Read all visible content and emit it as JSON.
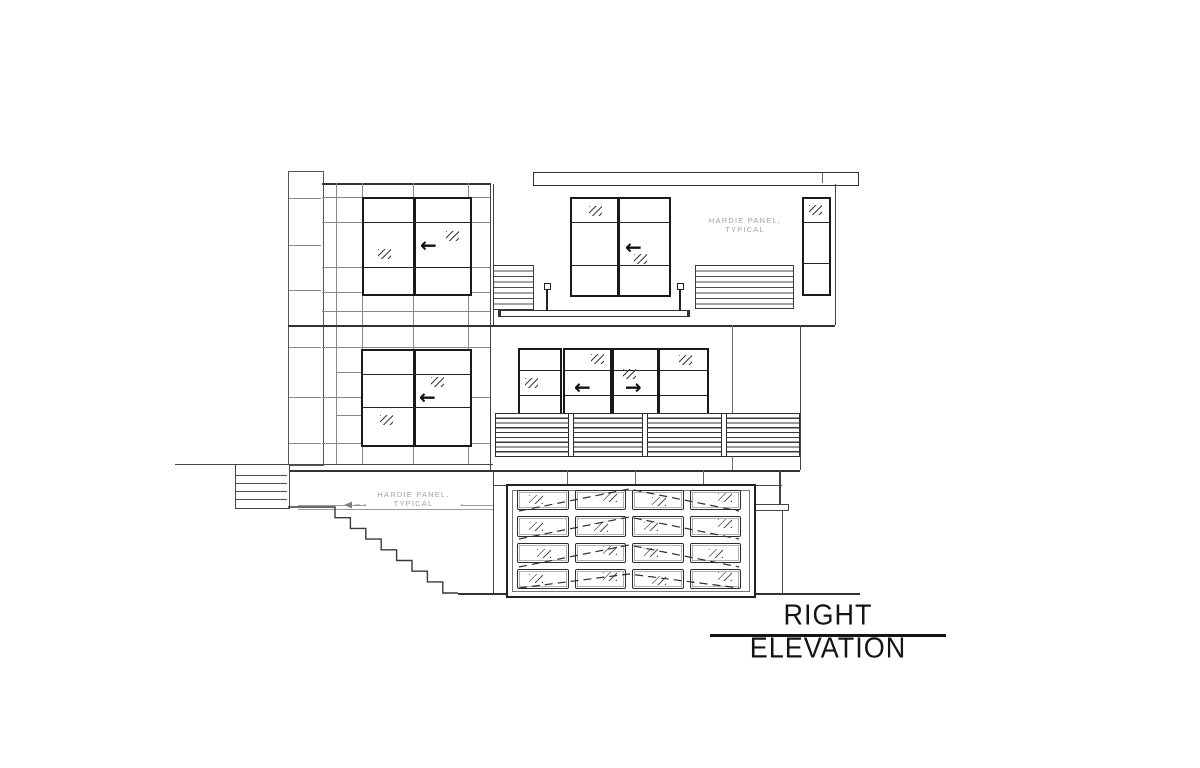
{
  "sheet": {
    "title": "RIGHT ELEVATION",
    "labels": {
      "hardie_panel_upper": {
        "line1": "HARDIE PANEL,",
        "line2": "TYPICAL"
      },
      "hardie_panel_lower": {
        "line1": "HARDIE PANEL,",
        "line2": "TYPICAL"
      }
    },
    "symbols": {
      "slide_left": "←",
      "slide_right": "→"
    },
    "colors": {
      "ink": "#3a3a3a",
      "window_frame": "#1a1a1a",
      "panel_grid": "#8a8a8a",
      "annotation_text": "#a3a3a3",
      "title_text": "#141414",
      "paper": "#ffffff"
    }
  }
}
